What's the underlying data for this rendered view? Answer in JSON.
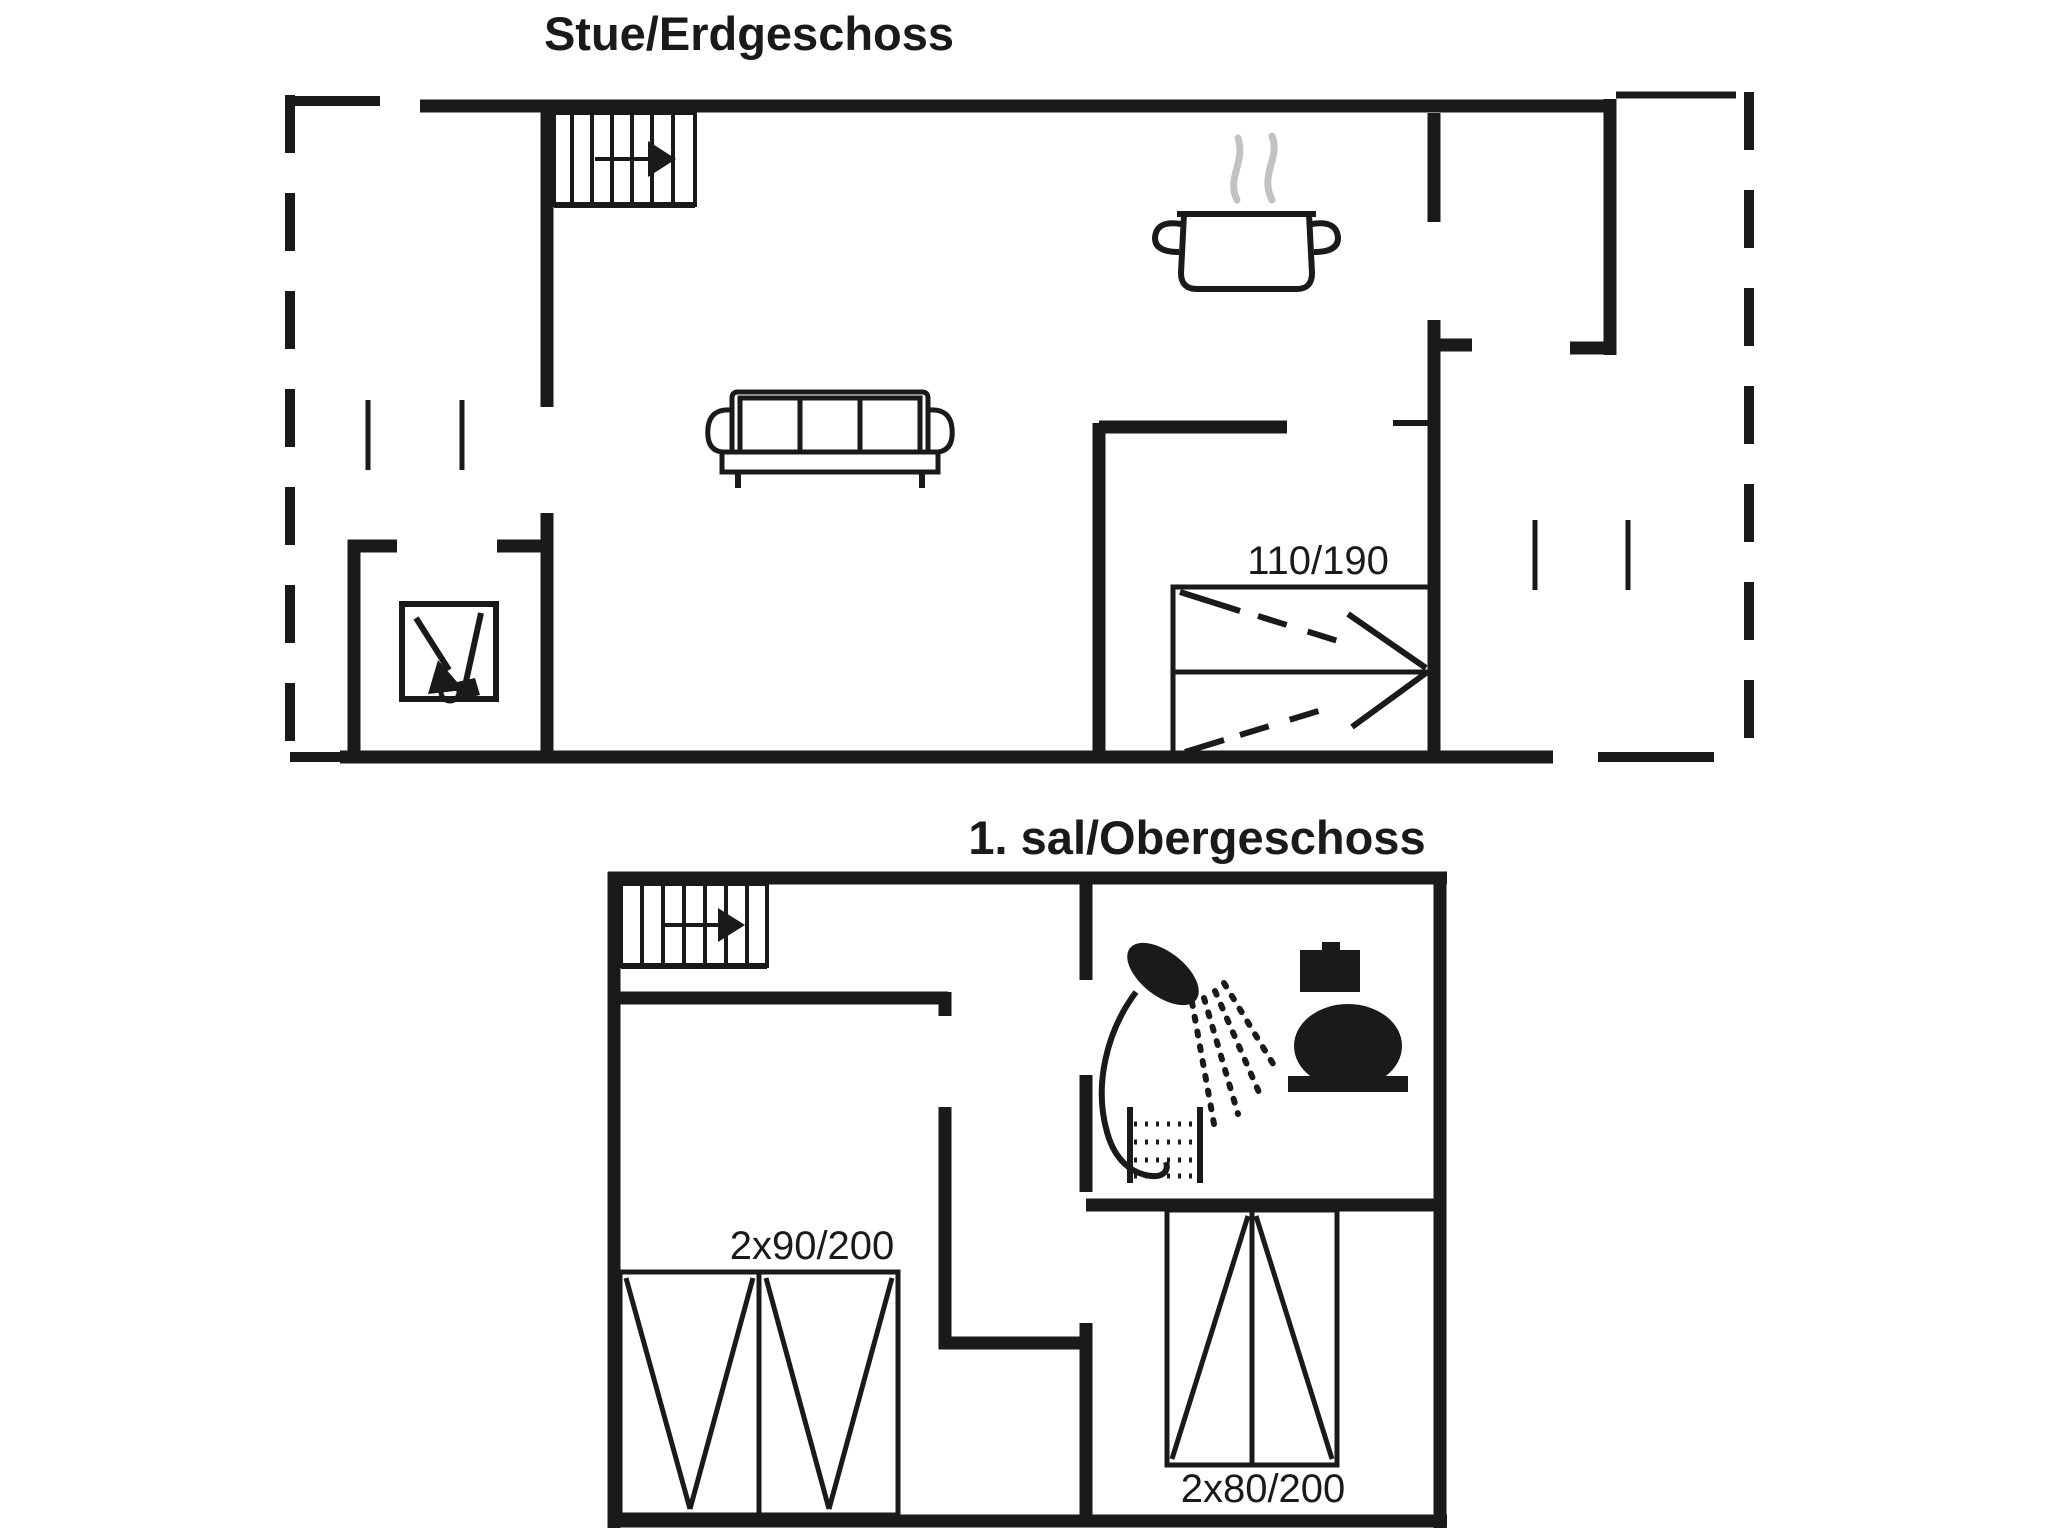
{
  "canvas": {
    "width": 2048,
    "height": 1536,
    "background": "#ffffff",
    "ink": "#1a1a1a",
    "steam_color": "#c2c2c2"
  },
  "ground_floor": {
    "title": "Stue/Erdgeschoss",
    "bed_label": "110/190",
    "icons": [
      "stairs-up-icon",
      "cooking-pot-icon",
      "sofa-icon",
      "wood-stove-icon",
      "double-bed-icon"
    ]
  },
  "upper_floor": {
    "title": "1. sal/Obergeschoss",
    "bed_left_label": "2x90/200",
    "bed_right_label": "2x80/200",
    "icons": [
      "stairs-up-icon",
      "shower-icon",
      "toilet-icon",
      "bunk-ladder-icon",
      "double-bed-icon",
      "double-bed-icon"
    ]
  }
}
